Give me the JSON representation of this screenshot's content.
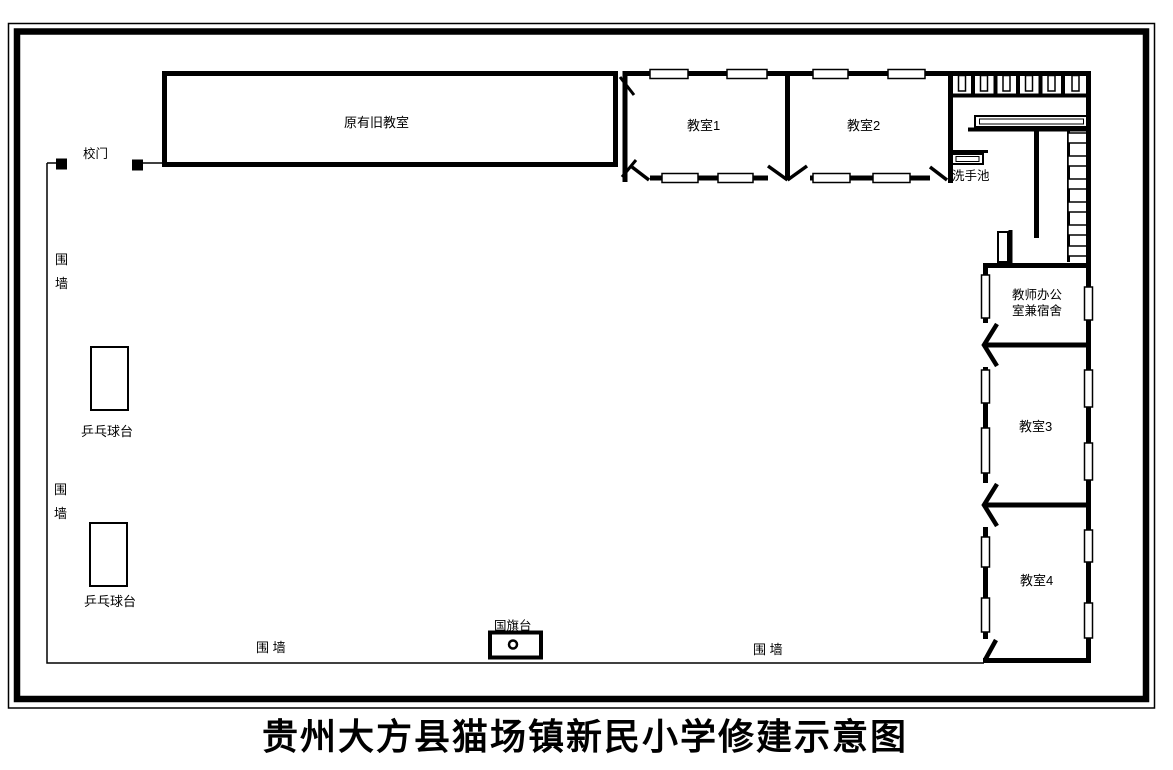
{
  "title": "贵州大方县猫场镇新民小学修建示意图",
  "labels": {
    "school_gate": "校门",
    "old_classroom": "原有旧教室",
    "classroom1": "教室1",
    "classroom2": "教室2",
    "wash_basin": "洗手池",
    "teacher_office": "教师办公\n室兼宿舍",
    "classroom3": "教室3",
    "classroom4": "教室4",
    "wall_left_upper": "围墙",
    "wall_left_lower": "围墙",
    "wall_bottom_left": "围 墙",
    "wall_bottom_right": "围 墙",
    "ping_pong_table_1": "乒乓球台",
    "ping_pong_table_2": "乒乓球台",
    "flag_platform": "国旗台"
  },
  "colors": {
    "line": "#000000",
    "background": "#ffffff"
  }
}
